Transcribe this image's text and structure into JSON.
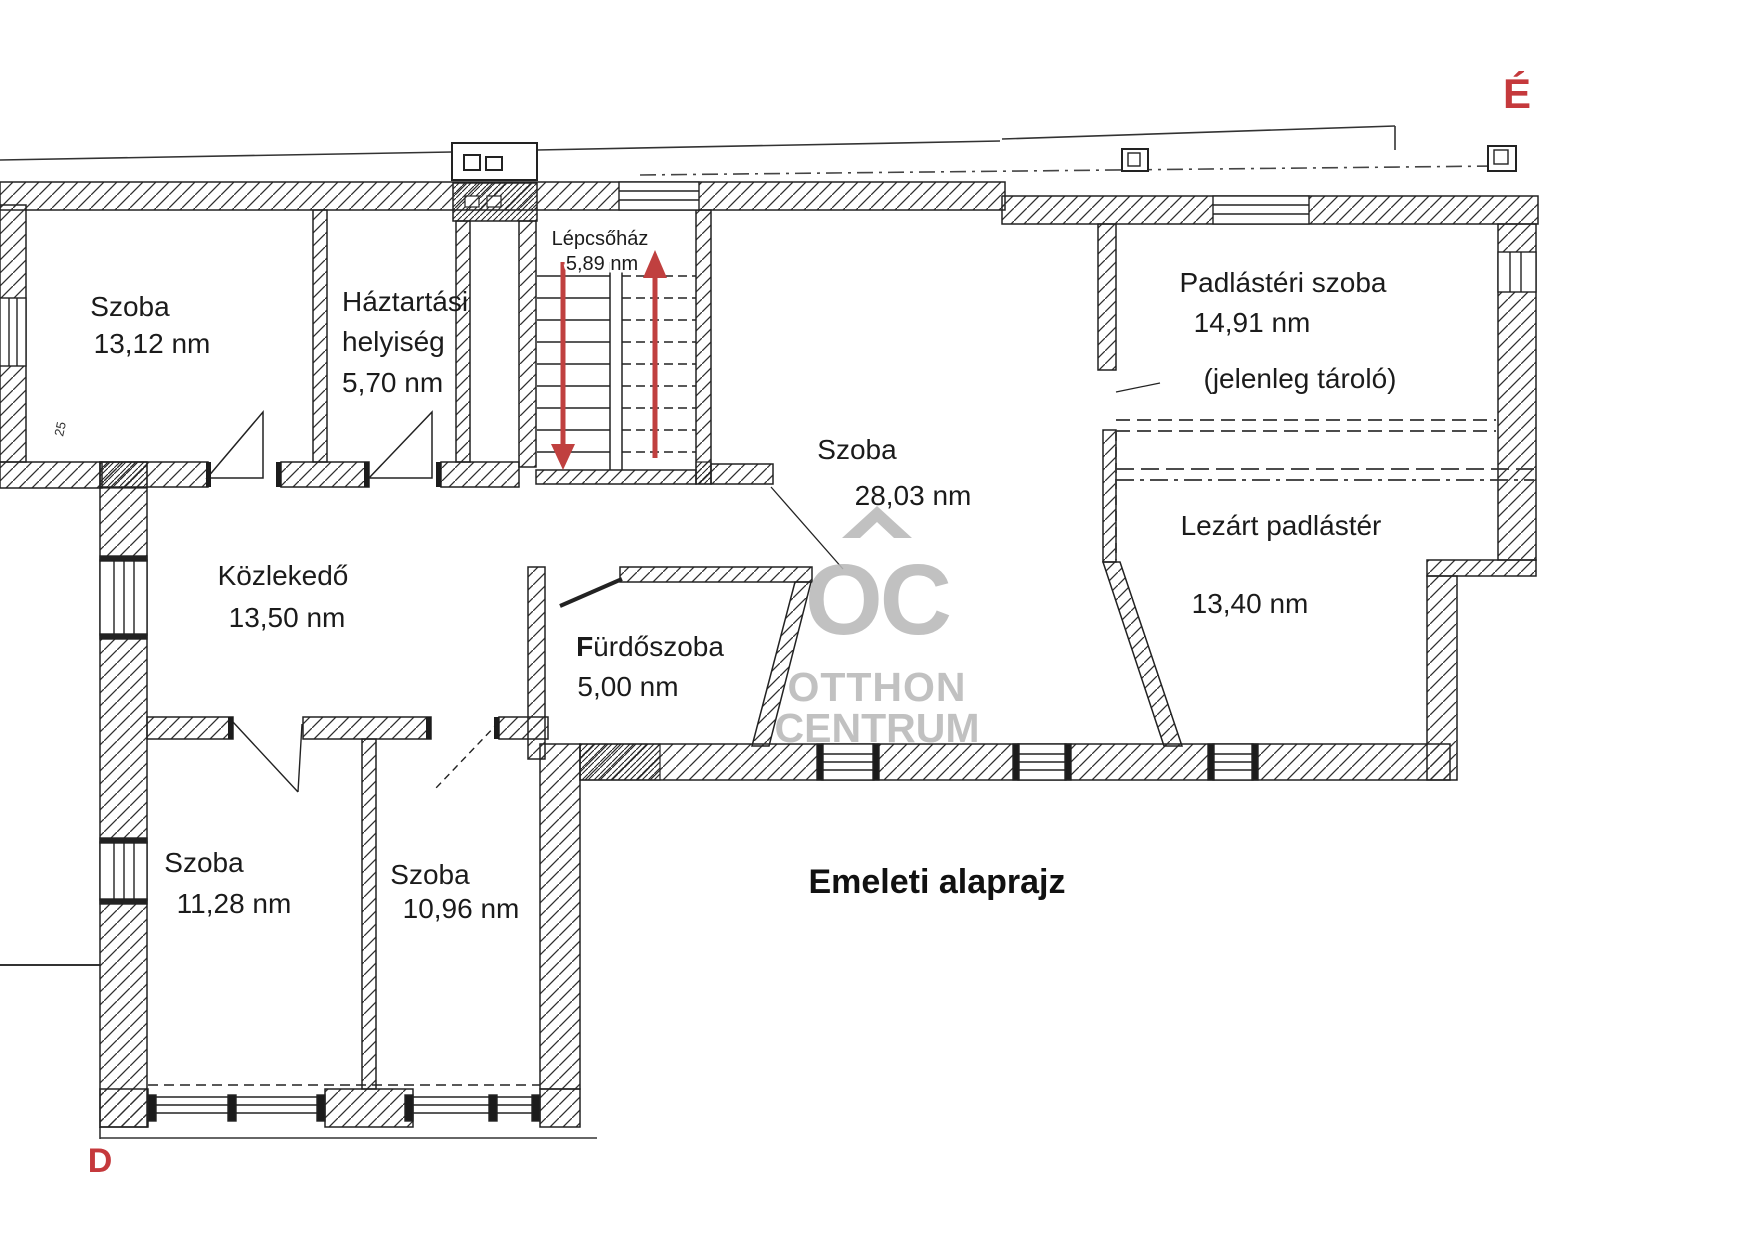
{
  "plan": {
    "title": "Emeleti alaprajz",
    "compass": {
      "north": "É",
      "south": "D"
    },
    "watermark": {
      "monogram": "OC",
      "word1": "OTTHON",
      "word2": "CENTRUM"
    },
    "colors": {
      "ink": "#1c1c1c",
      "accent_red": "#c0403f",
      "compass_red": "#c5393c",
      "watermark_gray": "#b9b9b9"
    },
    "small_dimension_label": "25",
    "rooms": [
      {
        "id": "szoba-13",
        "name": "Szoba",
        "area": "13,12 nm"
      },
      {
        "id": "haztartasi-helyiseg",
        "name_line1": "Háztartási",
        "name_line2": "helyiség",
        "area": "5,70 nm"
      },
      {
        "id": "lepcsohaz",
        "name": "Lépcsőház",
        "area": "5,89 nm"
      },
      {
        "id": "szoba-28",
        "name": "Szoba",
        "area": "28,03 nm"
      },
      {
        "id": "padlasteri-szoba",
        "name": "Padlástéri szoba",
        "area": "14,91 nm",
        "note": "(jelenleg tároló)"
      },
      {
        "id": "lezart-padlaster",
        "name": "Lezárt padlástér",
        "area": "13,40 nm"
      },
      {
        "id": "kozlekedo",
        "name": "Közlekedő",
        "area": "13,50 nm"
      },
      {
        "id": "furdoszoba",
        "name_first_letter": "F",
        "name_rest": "ürdőszoba",
        "area": "5,00 nm"
      },
      {
        "id": "szoba-11",
        "name": "Szoba",
        "area": "11,28 nm"
      },
      {
        "id": "szoba-10",
        "name": "Szoba",
        "area": "10,96 nm"
      }
    ]
  }
}
